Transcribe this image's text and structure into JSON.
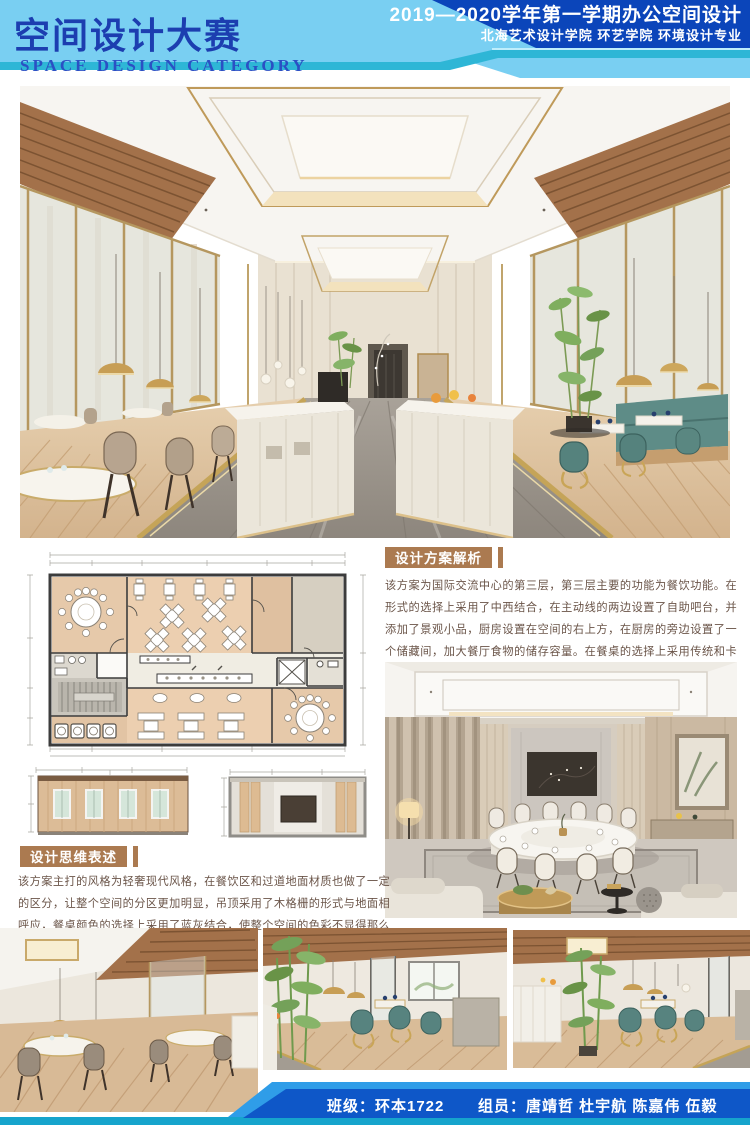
{
  "header": {
    "title_cn": "空间设计大赛",
    "title_en": "SPACE DESIGN CATEGORY",
    "banner_line1": "2019—2020学年第一学期办公空间设计",
    "banner_line2": "北海艺术设计学院 环艺学院 环境设计专业"
  },
  "sections": {
    "analysis": {
      "badge": "设计方案解析",
      "body": "该方案为国际交流中心的第三层，第三层主要的功能为餐饮功能。在形式的选择上采用了中西结合，在主动线的两边设置了自助吧台，并添加了景观小品，厨房设置在空间的右上方，在厨房的旁边设置了一个储藏间，加大餐厅食物的储存容量。在餐桌的选择上采用传统和卡座相结合，并设置了两个豪华包间,专门为高端的客户群体量身定做。"
    },
    "concept": {
      "badge": "设计思维表述",
      "body": "该方案主打的风格为轻奢现代风格，在餐饮区和过道地面材质也做了一定的区分，让整个空间的分区更加明显，吊顶采用了木格栅的形式与地面相呼应，餐桌颜色的选择上采用了蓝灰结合，使整个空间的色彩不显得那么单一,通过隔断区分了传统餐区和卡座区域。"
    }
  },
  "footer": {
    "class_label": "班级：环本1722",
    "members_label": "组员：唐靖哲 杜宇航 陈嘉伟 伍毅"
  },
  "images": {
    "main_render": "restaurant-hall-render",
    "floor_plan": "third-floor-plan",
    "elevation_left": "wall-elevation-a",
    "elevation_right": "wall-elevation-b",
    "private_room": "vip-dining-room-render",
    "photo_1": "dining-area-render-1",
    "photo_2": "dining-area-render-2",
    "photo_3": "dining-area-render-3"
  },
  "colors": {
    "header_light_blue": "#79cff2",
    "header_navy": "#0b45ba",
    "title_blue": "#1c3eb0",
    "teal_accent": "#2eb6d6",
    "badge_brown": "#ab7a50",
    "body_text": "#6a5448",
    "footer_blue": "#0e57c8",
    "footer_teal": "#16a4cc"
  }
}
